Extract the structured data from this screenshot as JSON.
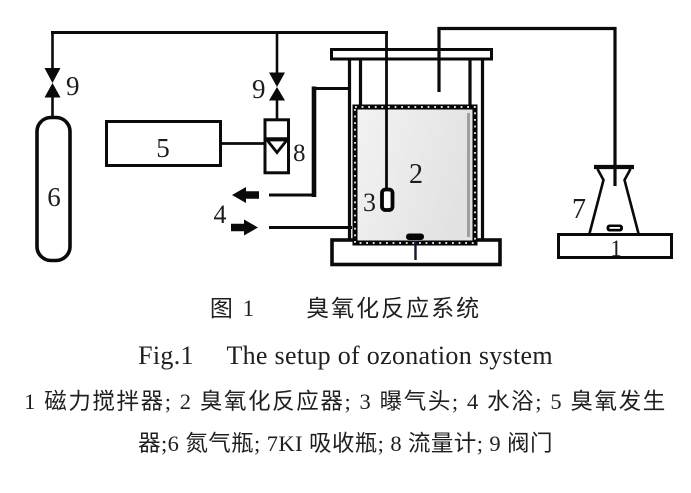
{
  "figure": {
    "caption_cn": "图 1　　臭氧化反应系统",
    "caption_en": "Fig.1　 The setup of ozonation system",
    "legend_line_1": "1 磁力搅拌器; 2 臭氧化反应器; 3 曝气头; 4 水浴; 5 臭氧发生",
    "legend_line_2": "器;6 氮气瓶; 7KI 吸收瓶; 8 流量计; 9 阀门"
  },
  "diagram_labels": {
    "valve_left": "9",
    "valve_right": "9",
    "nitrogen_cylinder": "6",
    "ozone_generator": "5",
    "flow_meter": "8",
    "water_bath": "4",
    "reactor": "2",
    "aerator": "3",
    "ki_flask": "7",
    "stirrer_right": "1"
  },
  "colors": {
    "line": "#0a0a0a",
    "label_text": "#1c1c1c",
    "caption_text": "#1f1f1f",
    "vessel_fill_light": "#f2f2f2",
    "vessel_fill_dark": "#e2e2e2",
    "background": "#ffffff"
  }
}
